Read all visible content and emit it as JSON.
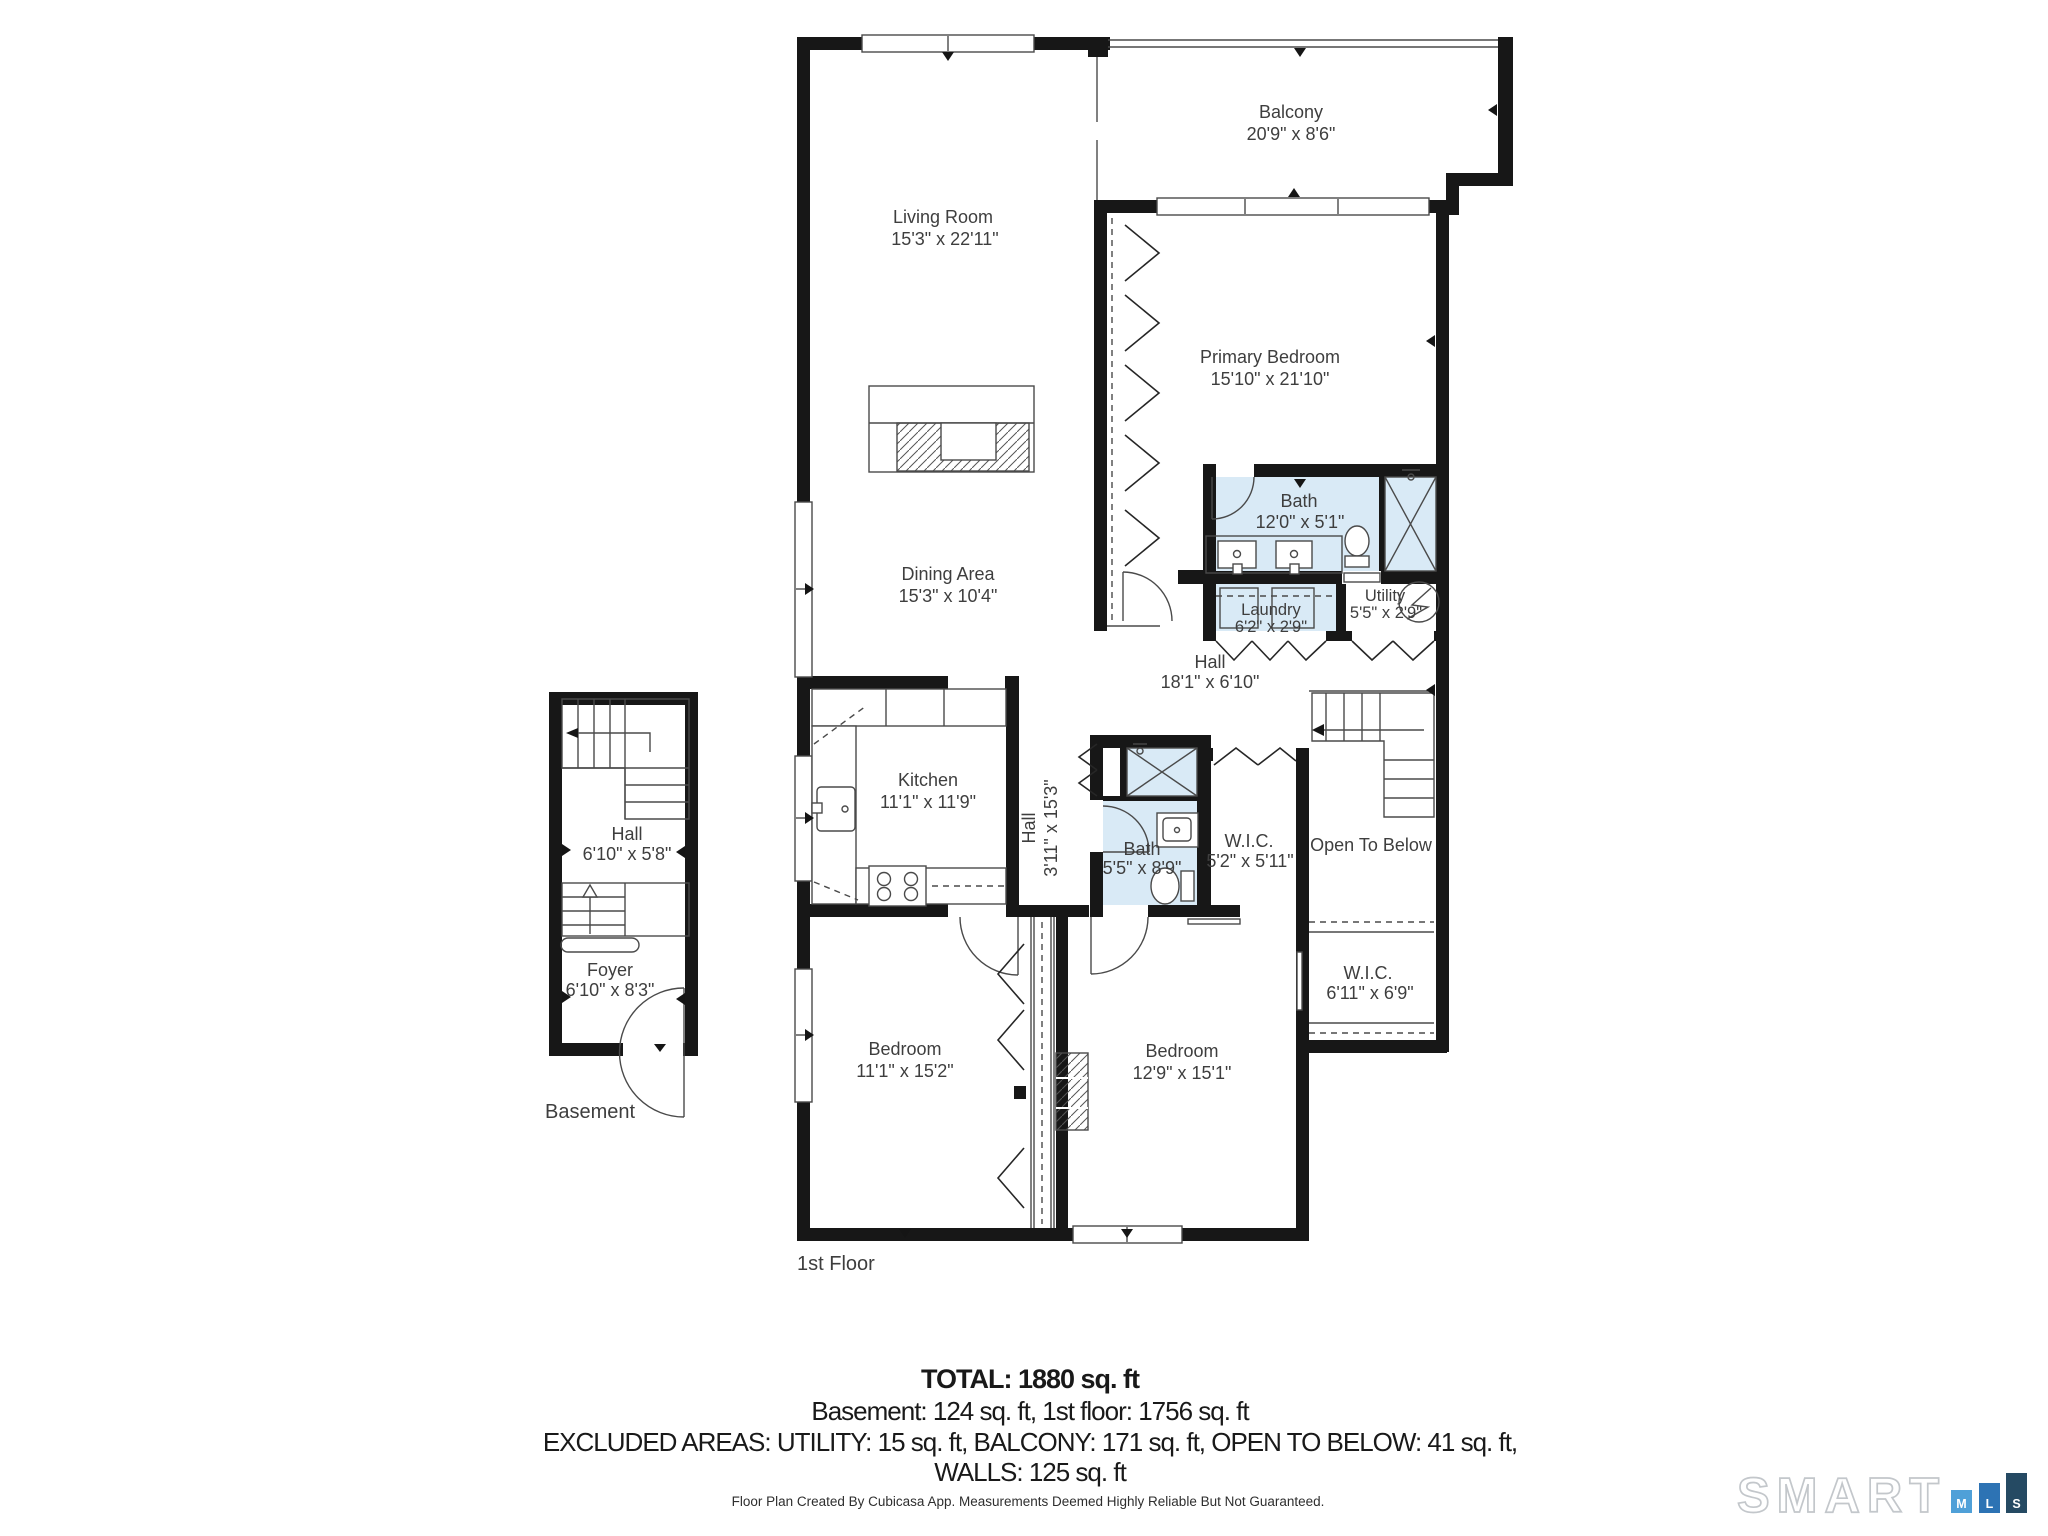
{
  "colors": {
    "bath_fill": "#d9eaf6",
    "wall": "#171717",
    "label_text": "#3e3e3e",
    "logo_outline": "#c3c7cb",
    "logo_m": "#4fa0d8",
    "logo_l": "#2d73b4",
    "logo_s": "#254a63"
  },
  "floors": {
    "first_label": "1st Floor",
    "basement_label": "Basement"
  },
  "rooms": {
    "balcony": {
      "name": "Balcony",
      "dims": "20'9\" x 8'6\""
    },
    "living": {
      "name": "Living Room",
      "dims": "15'3\" x 22'11\""
    },
    "primary_bedroom": {
      "name": "Primary Bedroom",
      "dims": "15'10\" x 21'10\""
    },
    "primary_bath": {
      "name": "Bath",
      "dims": "12'0\" x 5'1\""
    },
    "laundry": {
      "name": "Laundry",
      "dims": "6'2\" x 2'9\""
    },
    "utility": {
      "name": "Utility",
      "dims": "5'5\" x 2'9\""
    },
    "hall_main": {
      "name": "Hall",
      "dims": "18'1\" x 6'10\""
    },
    "dining": {
      "name": "Dining Area",
      "dims": "15'3\" x 10'4\""
    },
    "kitchen": {
      "name": "Kitchen",
      "dims": "11'1\" x 11'9\""
    },
    "hall_corridor": {
      "name": "Hall",
      "dims": "3'11\" x 15'3\""
    },
    "hall_bath": {
      "name": "Bath",
      "dims": "5'5\" x 8'9\""
    },
    "wic_hall": {
      "name": "W.I.C.",
      "dims": "5'2\" x 5'11\""
    },
    "open_to_below": {
      "name": "Open To Below"
    },
    "wic_bedroom": {
      "name": "W.I.C.",
      "dims": "6'11\" x 6'9\""
    },
    "bedroom_left": {
      "name": "Bedroom",
      "dims": "11'1\" x 15'2\""
    },
    "bedroom_right": {
      "name": "Bedroom",
      "dims": "12'9\" x 15'1\""
    },
    "basement_hall": {
      "name": "Hall",
      "dims": "6'10\" x 5'8\""
    },
    "foyer": {
      "name": "Foyer",
      "dims": "6'10\" x 8'3\""
    }
  },
  "summary": {
    "total": "TOTAL: 1880 sq. ft",
    "floors": "Basement: 124 sq. ft, 1st floor: 1756 sq. ft",
    "excluded_line1": "EXCLUDED AREAS: UTILITY: 15 sq. ft, BALCONY: 171 sq. ft, OPEN TO BELOW: 41 sq. ft,",
    "excluded_line2": "WALLS: 125 sq. ft"
  },
  "footer": {
    "credit": "Floor Plan Created By Cubicasa App. Measurements Deemed Highly Reliable But Not Guaranteed."
  },
  "logo": {
    "brand": "SMART",
    "m": "M",
    "l": "L",
    "s": "S"
  }
}
